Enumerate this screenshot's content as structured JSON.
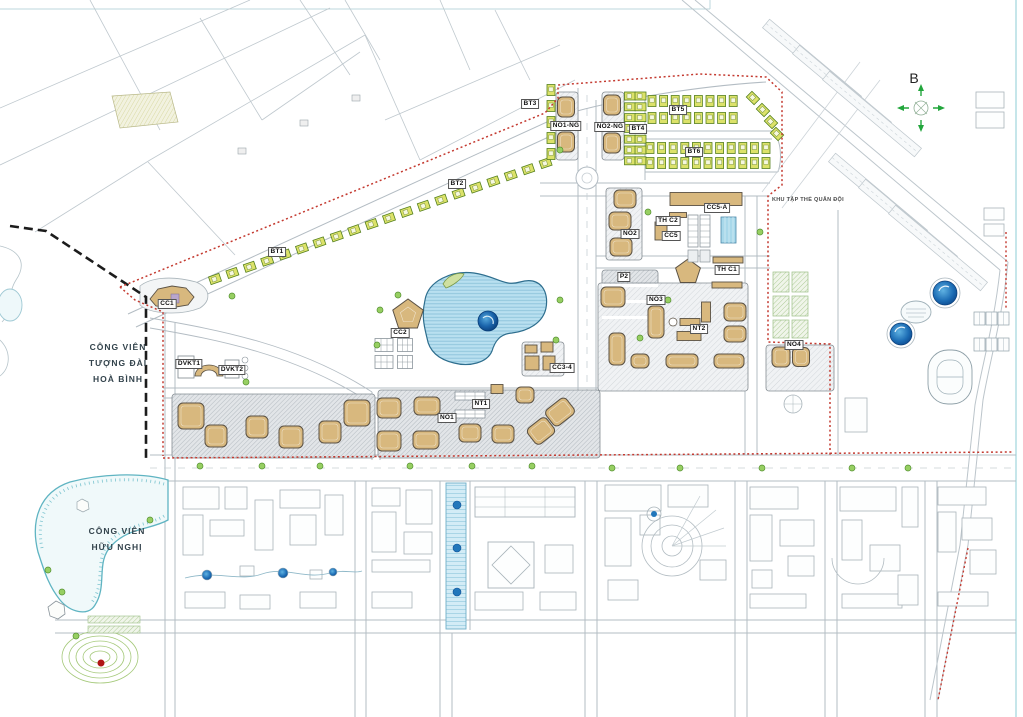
{
  "compass": {
    "label": "B"
  },
  "parks": {
    "hoa_binh": [
      "CÔNG VIÊN",
      "TƯỢNG ĐÀI",
      "HOÀ BÌNH"
    ],
    "huu_nghi": [
      "CÔNG VIÊN",
      "HỮU NGHỊ"
    ]
  },
  "annotations": {
    "military_quarter": "KHU TẬP THỂ QUÂN ĐỘI"
  },
  "zones": [
    {
      "id": "cc1",
      "label": "CC1",
      "x": 167,
      "y": 304
    },
    {
      "id": "bt1",
      "label": "BT1",
      "x": 277,
      "y": 252
    },
    {
      "id": "bt2",
      "label": "BT2",
      "x": 457,
      "y": 184
    },
    {
      "id": "bt3",
      "label": "BT3",
      "x": 530,
      "y": 104
    },
    {
      "id": "no1ng",
      "label": "NO1-NG",
      "x": 566,
      "y": 126
    },
    {
      "id": "no2ng",
      "label": "NO2-NG",
      "x": 610,
      "y": 127
    },
    {
      "id": "bt4",
      "label": "BT4",
      "x": 638,
      "y": 129
    },
    {
      "id": "bt5",
      "label": "BT5",
      "x": 678,
      "y": 110
    },
    {
      "id": "bt6",
      "label": "BT6",
      "x": 694,
      "y": 152
    },
    {
      "id": "cc5a",
      "label": "CC5-A",
      "x": 717,
      "y": 208
    },
    {
      "id": "thc2",
      "label": "TH C2",
      "x": 668,
      "y": 221
    },
    {
      "id": "cc5",
      "label": "CC5",
      "x": 671,
      "y": 236
    },
    {
      "id": "no2",
      "label": "NO2",
      "x": 630,
      "y": 234
    },
    {
      "id": "p2",
      "label": "P2",
      "x": 624,
      "y": 277
    },
    {
      "id": "thc1",
      "label": "TH C1",
      "x": 727,
      "y": 270
    },
    {
      "id": "no3",
      "label": "NO3",
      "x": 656,
      "y": 300
    },
    {
      "id": "nt2",
      "label": "NT2",
      "x": 699,
      "y": 329
    },
    {
      "id": "no4",
      "label": "NO4",
      "x": 794,
      "y": 345
    },
    {
      "id": "cc2",
      "label": "CC2",
      "x": 400,
      "y": 333
    },
    {
      "id": "cc34",
      "label": "CC3-4",
      "x": 562,
      "y": 368
    },
    {
      "id": "nt1",
      "label": "NT1",
      "x": 481,
      "y": 404
    },
    {
      "id": "no1",
      "label": "NO1",
      "x": 447,
      "y": 418
    },
    {
      "id": "dvkt1",
      "label": "DVKT1",
      "x": 189,
      "y": 364
    },
    {
      "id": "dvkt2",
      "label": "DVKT2",
      "x": 232,
      "y": 370
    }
  ],
  "palette": {
    "boundary_red": "#c43a30",
    "park_boundary_black": "#1c1c1c",
    "tower_tan": "#d8b87e",
    "villa_green": "#dce269",
    "lake_fill": "#b7dff0",
    "island_blue": "#0d4f94",
    "water_teal": "#6fbecb",
    "compass_green": "#22a63c",
    "road_gray": "#b3bcc3"
  }
}
